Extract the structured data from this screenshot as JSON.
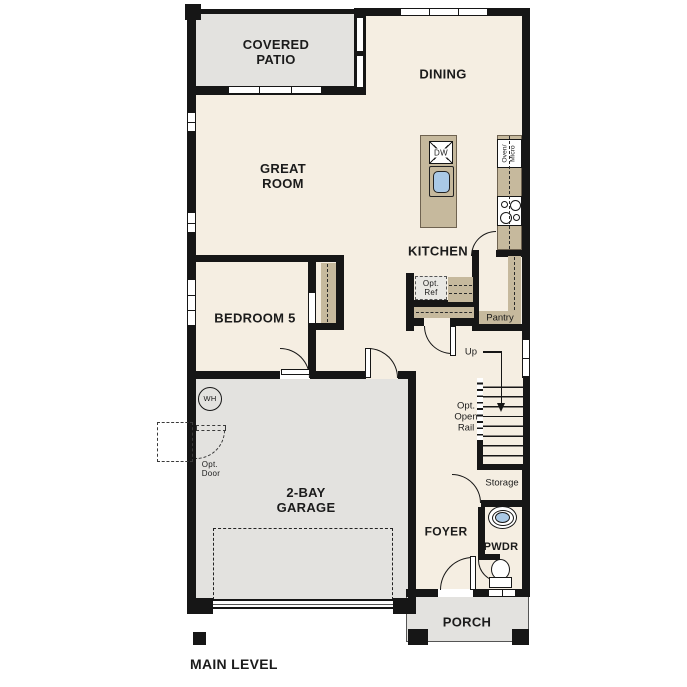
{
  "plan": {
    "title": "MAIN LEVEL",
    "rooms": {
      "covered_patio": "COVERED\nPATIO",
      "dining": "DINING",
      "great_room": "GREAT\nROOM",
      "kitchen": "KITCHEN",
      "bedroom5": "BEDROOM 5",
      "garage": "2-BAY\nGARAGE",
      "foyer": "FOYER",
      "powder": "PWDR",
      "porch": "PORCH"
    },
    "labels": {
      "pantry": "Pantry",
      "storage": "Storage",
      "up": "Up",
      "opt_open_rail": "Opt.\nOpen\nRail",
      "opt_ref": "Opt.\nRef",
      "opt_door": "Opt.\nDoor",
      "dishwasher": "DW",
      "water_heater": "WH",
      "oven_micro": "Oven/\nMicro"
    },
    "colors": {
      "floor": "#f5eee2",
      "exterior_concrete": "#e3e2df",
      "counter_tan": "#c6b99d",
      "wall": "#161616",
      "fixture_blue": "#aac9e6"
    }
  }
}
